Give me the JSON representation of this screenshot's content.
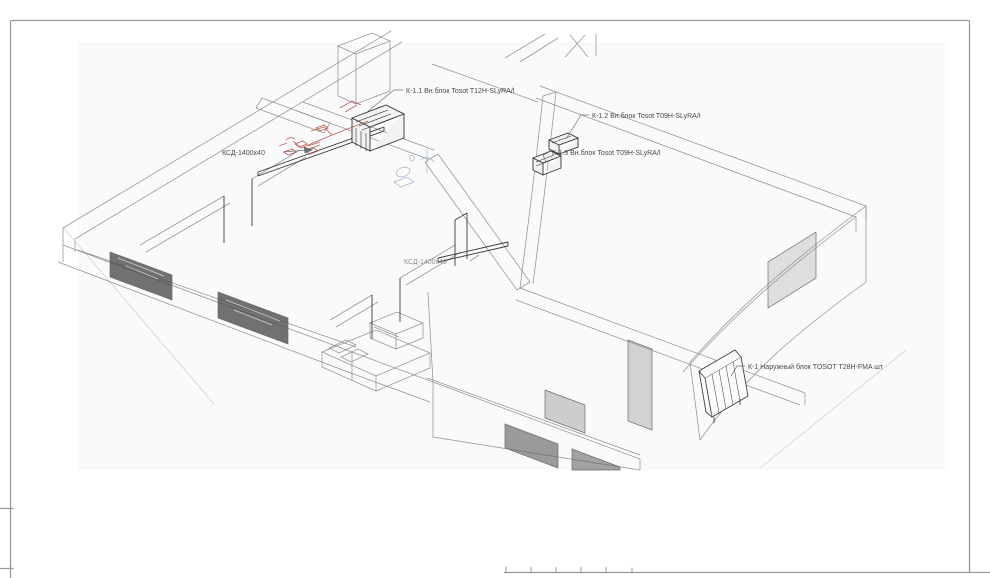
{
  "page": {
    "background": "#ffffff",
    "canvas_tint": "#fafafa"
  },
  "colors": {
    "frame": "#9a9a9a",
    "linework": "#8b8b8b",
    "dark_linework": "#3a3a3a",
    "duct_red": "#b0524d",
    "fixture_blue": "#9fb3c9",
    "label_text": "#4a4a4a",
    "label_text_muted": "#8f8f8f"
  },
  "annotations": [
    {
      "id": "k11",
      "text": "К-1.1 Вн.блок Tosot T12H-SLyRA/I"
    },
    {
      "id": "k12",
      "text": "К-1.2 Вн.блок Tosot T09H-SLyRA/I"
    },
    {
      "id": "k13",
      "text": "К-1.3 Вн.блок Tosot T09H-SLyRA/I"
    },
    {
      "id": "ksd1",
      "text": "КСД-1400х40"
    },
    {
      "id": "ksd2",
      "text": "КСД-1400х40"
    },
    {
      "id": "k1",
      "text": "К-1 Наружный блок TOSOT T28H-FMA шт"
    }
  ]
}
